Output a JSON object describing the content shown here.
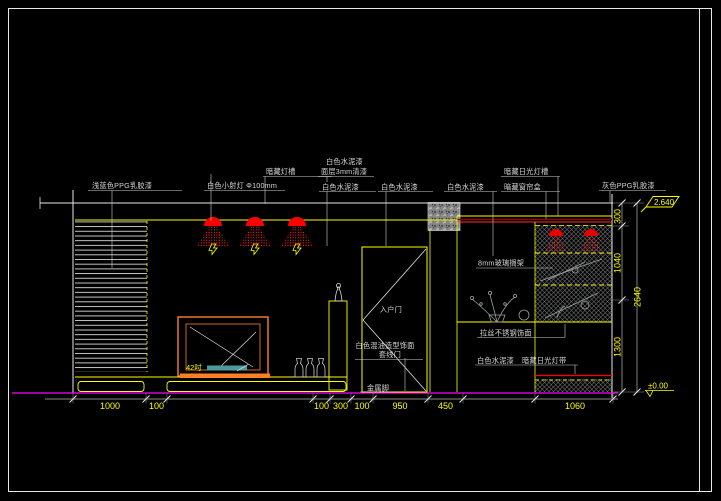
{
  "canvas": {
    "width": 721,
    "height": 501,
    "background": "#000000"
  },
  "colors": {
    "line_white": "#e8e8e8",
    "cad_yellow": "#ffff00",
    "floor_magenta": "#ff00ff",
    "accent_orange": "#ff7f27",
    "light_red": "#ff0000",
    "curtain_dark_red": "#8b0000",
    "shelf_teal": "#4e9a9a",
    "hatch_gray": "#8a8a8a"
  },
  "annotations": {
    "left_wall_paint": "浅蓝色PPG乳胶漆",
    "downlight": "白色小射灯 Φ100mm",
    "light_cove": "暗藏灯槽",
    "white_cement_top1": "白色水泥漆",
    "white_cement_top1_sub": "面层3mm清漆",
    "white_cement_top2": "白色水泥漆",
    "white_cement_top3": "白色水泥漆",
    "white_cement_top4": "白色水泥漆",
    "fluorescent_cove": "暗藏日光灯槽",
    "curtain_box": "暗藏窗帘盒",
    "right_wall_paint": "灰色PPG乳胶漆",
    "entry_door": "入户门",
    "door_finish_line1": "白色混油造型饰面",
    "door_finish_line2": "套线门",
    "metal_feet": "金属脚",
    "tv_size": "42吋",
    "glass_shelf": "8mm玻璃搁架",
    "stainless_finish": "拉丝不锈钢饰面",
    "white_cement_bottom": "白色水泥漆",
    "light_strip": "暗藏日光灯带"
  },
  "elevation_markers": {
    "ceiling": "2.640",
    "floor": "±0.00"
  },
  "dimensions": {
    "bottom": [
      "1000",
      "100",
      "100",
      "300",
      "100",
      "950",
      "450",
      "1060"
    ],
    "right": [
      "300",
      "1040",
      "1300"
    ],
    "right_total": "2640"
  }
}
